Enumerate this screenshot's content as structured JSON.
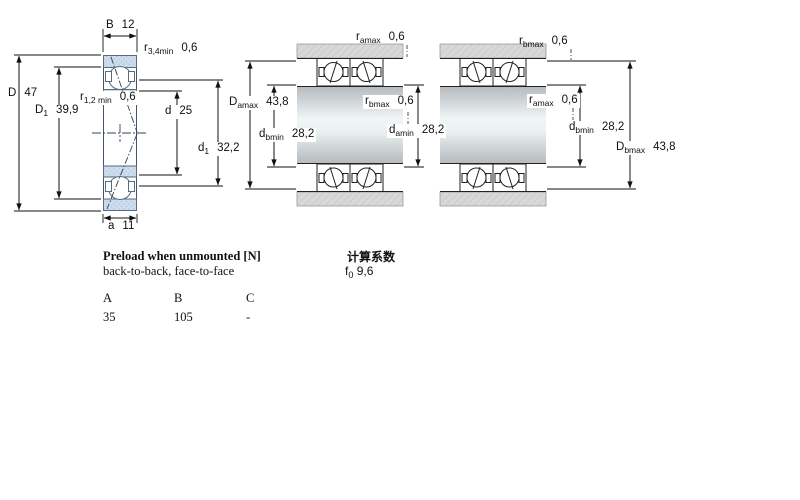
{
  "drawings": {
    "left": {
      "labels": {
        "B": {
          "sym": "B",
          "val": "12"
        },
        "r34": {
          "sym": "r",
          "sub": "3,4min",
          "val": "0,6"
        },
        "D": {
          "sym": "D",
          "val": "47"
        },
        "D1": {
          "sym": "D",
          "sub": "1",
          "val": "39,9"
        },
        "r12": {
          "sym": "r",
          "sub": "1,2 min",
          "val": "0,6"
        },
        "d": {
          "sym": "d",
          "val": "25"
        },
        "d1": {
          "sym": "d",
          "sub": "1",
          "val": "32,2"
        },
        "a": {
          "sym": "a",
          "val": "11"
        }
      }
    },
    "middle": {
      "labels": {
        "ramax": {
          "sym": "r",
          "sub": "amax",
          "val": "0,6"
        },
        "Damax": {
          "sym": "D",
          "sub": "amax",
          "val": "43,8"
        },
        "rbmax": {
          "sym": "r",
          "sub": "bmax",
          "val": "0,6"
        },
        "dbmin": {
          "sym": "d",
          "sub": "bmin",
          "val": "28,2"
        },
        "damin": {
          "sym": "d",
          "sub": "amin",
          "val": "28,2"
        }
      }
    },
    "right": {
      "labels": {
        "rbmax": {
          "sym": "r",
          "sub": "bmax",
          "val": "0,6"
        },
        "ramax": {
          "sym": "r",
          "sub": "amax",
          "val": "0,6"
        },
        "dbmin": {
          "sym": "d",
          "sub": "bmin",
          "val": "28,2"
        },
        "Dbmax": {
          "sym": "D",
          "sub": "bmax",
          "val": "43,8"
        }
      }
    }
  },
  "preload": {
    "title": "Preload when unmounted [N]",
    "subtitle": "back-to-back, face-to-face",
    "columns": [
      "A",
      "B",
      "C"
    ],
    "values": [
      "35",
      "105",
      "-"
    ]
  },
  "factors": {
    "title": "计算系数",
    "f0": {
      "sym": "f",
      "sub": "0",
      "val": "9,6"
    }
  },
  "colors": {
    "bearing_fill": "#cdddee",
    "bearing_accent": "#aec5de",
    "bearing_stroke": "#5a6b80",
    "housing_fill": "#d8d8d8",
    "shaft_dark": "#b6babe",
    "shaft_light": "#f0f5f6",
    "outline": "#222222",
    "dim_line": "#111111"
  }
}
